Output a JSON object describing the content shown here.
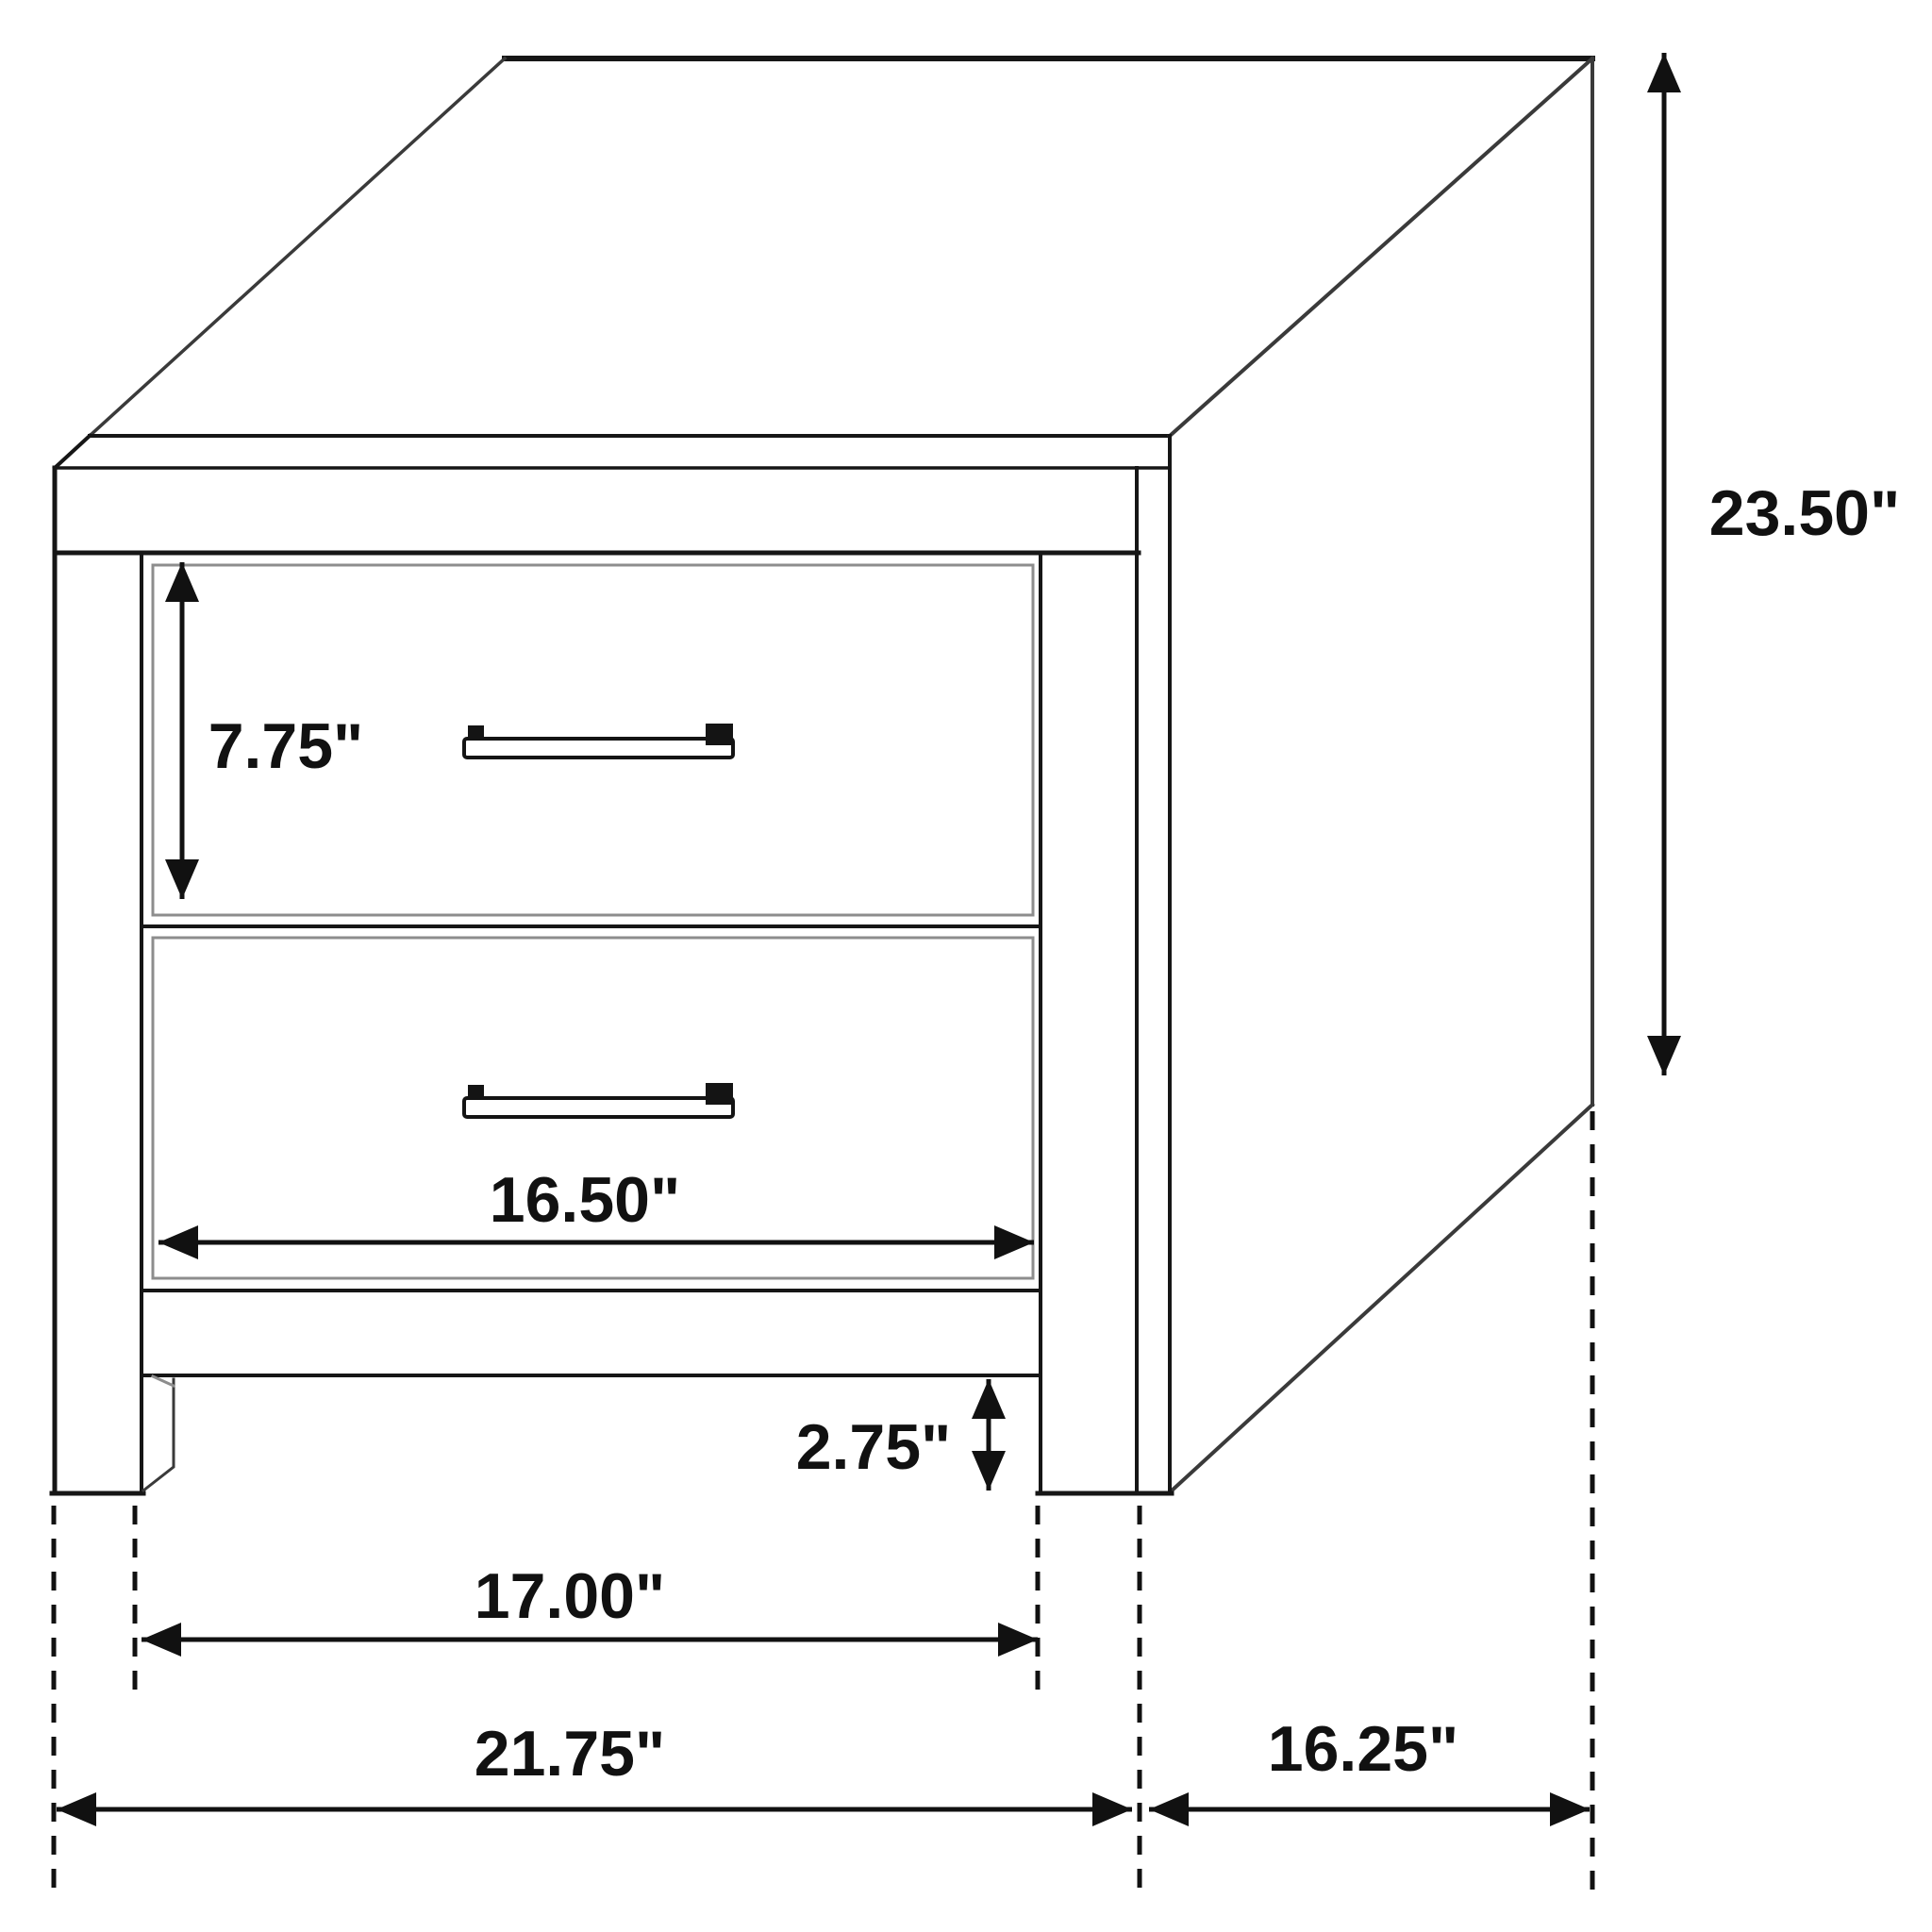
{
  "diagram": {
    "type": "furniture-dimension-drawing",
    "subject": "two-drawer nightstand isometric line drawing",
    "unit": "inches",
    "background_color": "#ffffff",
    "line_color": "#161616",
    "labels": {
      "overall_height": "23.50\"",
      "drawer_face_height": "7.75\"",
      "drawer_width": "16.50\"",
      "leg_height": "2.75\"",
      "inner_leg_span": "17.00\"",
      "overall_width": "21.75\"",
      "side_depth": "16.25\""
    }
  }
}
